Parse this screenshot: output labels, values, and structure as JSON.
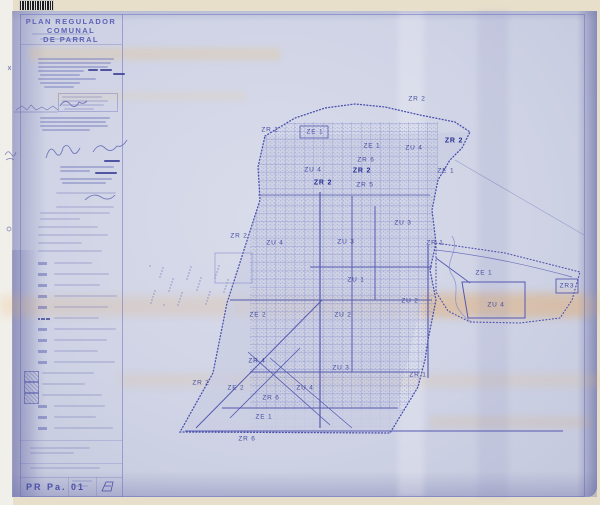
{
  "document": {
    "title_line1": "PLAN REGULADOR COMUNAL",
    "title_line2": "DE PARRAL",
    "sheet_code": "PR Pa. 01"
  },
  "map": {
    "zone_labels": [
      {
        "text": "ZR 2",
        "x": 417,
        "y": 99,
        "bold": false
      },
      {
        "text": "ZR 2",
        "x": 270,
        "y": 130,
        "bold": false
      },
      {
        "text": "ZE 1",
        "x": 315,
        "y": 132,
        "bold": false
      },
      {
        "text": "ZE 1",
        "x": 372,
        "y": 146,
        "bold": false
      },
      {
        "text": "ZU 4",
        "x": 414,
        "y": 148,
        "bold": false
      },
      {
        "text": "ZR 2",
        "x": 454,
        "y": 141,
        "bold": true
      },
      {
        "text": "ZR 6",
        "x": 366,
        "y": 160,
        "bold": false
      },
      {
        "text": "ZR 2",
        "x": 362,
        "y": 171,
        "bold": true
      },
      {
        "text": "ZE 1",
        "x": 446,
        "y": 171,
        "bold": false
      },
      {
        "text": "ZU 4",
        "x": 313,
        "y": 170,
        "bold": false
      },
      {
        "text": "ZR 2",
        "x": 323,
        "y": 183,
        "bold": true
      },
      {
        "text": "ZR 5",
        "x": 365,
        "y": 185,
        "bold": false
      },
      {
        "text": "ZR 2",
        "x": 239,
        "y": 236,
        "bold": false
      },
      {
        "text": "ZU 4",
        "x": 275,
        "y": 243,
        "bold": false
      },
      {
        "text": "ZU 3",
        "x": 346,
        "y": 242,
        "bold": false
      },
      {
        "text": "ZU 3",
        "x": 403,
        "y": 223,
        "bold": false
      },
      {
        "text": "ZR 1",
        "x": 435,
        "y": 243,
        "bold": false
      },
      {
        "text": "ZU 1",
        "x": 356,
        "y": 280,
        "bold": false
      },
      {
        "text": "ZU 2",
        "x": 410,
        "y": 301,
        "bold": false
      },
      {
        "text": "ZE 2",
        "x": 258,
        "y": 315,
        "bold": false
      },
      {
        "text": "ZU 2",
        "x": 343,
        "y": 315,
        "bold": false
      },
      {
        "text": "ZR 4",
        "x": 257,
        "y": 361,
        "bold": false
      },
      {
        "text": "ZU 3",
        "x": 341,
        "y": 368,
        "bold": false
      },
      {
        "text": "ZR 1",
        "x": 418,
        "y": 375,
        "bold": false
      },
      {
        "text": "ZE 2",
        "x": 236,
        "y": 388,
        "bold": false
      },
      {
        "text": "ZU 4",
        "x": 305,
        "y": 388,
        "bold": false
      },
      {
        "text": "ZR 6",
        "x": 271,
        "y": 398,
        "bold": false
      },
      {
        "text": "ZR 2",
        "x": 201,
        "y": 383,
        "bold": false
      },
      {
        "text": "ZE 1",
        "x": 264,
        "y": 417,
        "bold": false
      },
      {
        "text": "ZR 6",
        "x": 247,
        "y": 439,
        "bold": false
      },
      {
        "text": "ZE 1",
        "x": 484,
        "y": 273,
        "bold": false
      },
      {
        "text": "ZU 4",
        "x": 496,
        "y": 305,
        "bold": false
      },
      {
        "text": "ZR3",
        "x": 567,
        "y": 286,
        "bold": false
      }
    ]
  }
}
